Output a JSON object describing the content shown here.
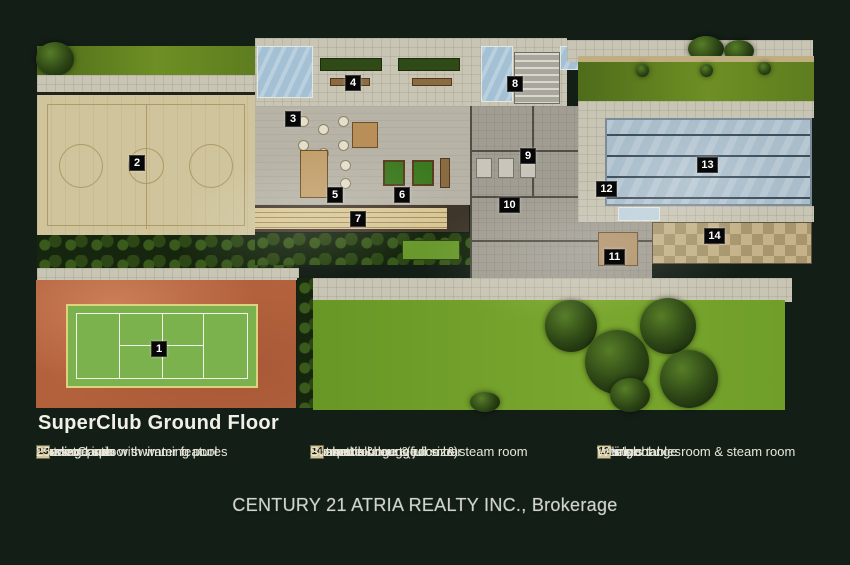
{
  "title": "SuperClub Ground Floor",
  "watermark_text": "CENTURY 21 ATRIA REALTY INC., Brokerage",
  "legend": {
    "columns": [
      {
        "items": [
          {
            "num": "1",
            "label": "Tennis Court"
          },
          {
            "num": "4",
            "label": "Outdoor patio with water features"
          },
          {
            "num": "7",
            "label": "Bowling lanes"
          },
          {
            "num": "10",
            "label": "Massage spa"
          },
          {
            "num": "13",
            "label": "25-metre indoor swimming pool"
          }
        ]
      },
      {
        "items": [
          {
            "num": "2",
            "label": "Basketball court (full size)"
          },
          {
            "num": "5",
            "label": "Internet lounge & juice bar"
          },
          {
            "num": "8",
            "label": "Entrance & lounge"
          },
          {
            "num": "11",
            "label": "Women's change room & steam room"
          },
          {
            "num": "14",
            "label": "Sun patio"
          }
        ]
      },
      {
        "items": [
          {
            "num": "3",
            "label": "Lounge"
          },
          {
            "num": "6",
            "label": "Billiards tables"
          },
          {
            "num": "9",
            "label": "Men's change room & steam room"
          },
          {
            "num": "12",
            "label": "Whirlpool"
          }
        ]
      }
    ]
  },
  "plan": {
    "markers": [
      {
        "num": "1"
      },
      {
        "num": "2"
      },
      {
        "num": "3"
      },
      {
        "num": "4"
      },
      {
        "num": "5"
      },
      {
        "num": "6"
      },
      {
        "num": "7"
      },
      {
        "num": "8"
      },
      {
        "num": "9"
      },
      {
        "num": "10"
      },
      {
        "num": "11"
      },
      {
        "num": "12"
      },
      {
        "num": "13"
      },
      {
        "num": "14"
      }
    ]
  },
  "palette": {
    "background": "#131e16",
    "grass_bright": "#74a32c",
    "grass_olive": "#5d7d1f",
    "pavement": "#c9c5b4",
    "basketball_court": "#cfc49c",
    "tennis_clay": "#b2613c",
    "tennis_turf": "#7cb24e",
    "pool_water": "#a9bdcb",
    "sun_patio": "#c5b289",
    "marker_bg": "#070707",
    "legend_badge": "#d3c89d"
  }
}
